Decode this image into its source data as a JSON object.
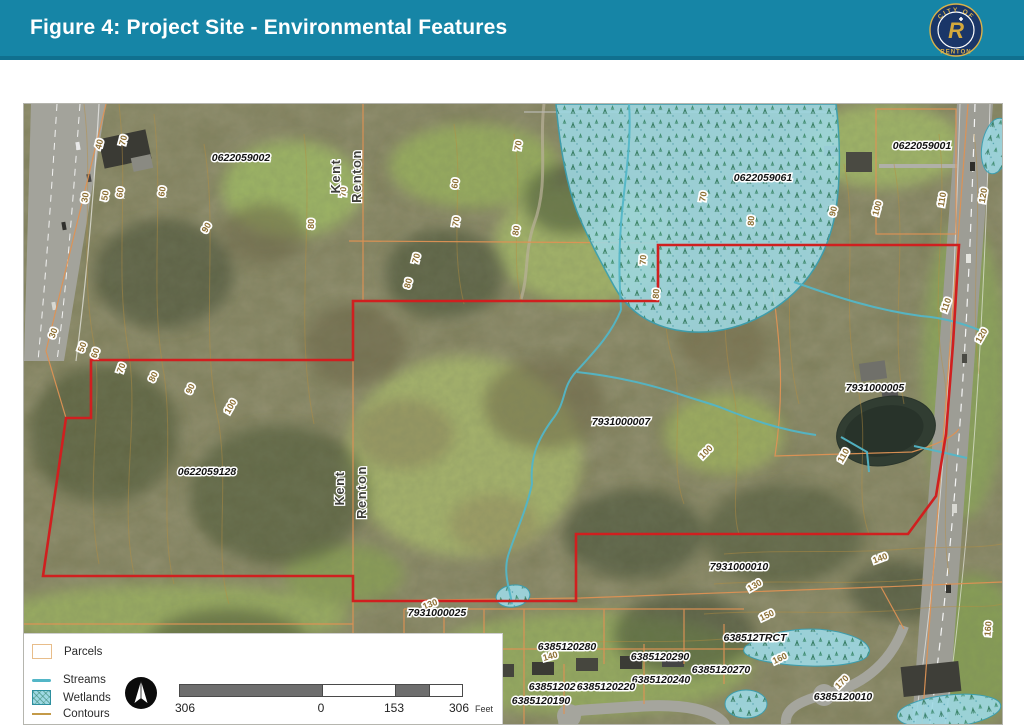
{
  "header": {
    "title": "Figure 4: Project Site - Environmental Features",
    "logo": {
      "top_text": "CITY OF",
      "bottom_text": "RENTON",
      "letter": "R"
    }
  },
  "legend": {
    "items": [
      {
        "label": "Parcels"
      },
      {
        "label": "Streams"
      },
      {
        "label": "Wetlands"
      },
      {
        "label": "Contours"
      }
    ],
    "scalebar": {
      "left": "306",
      "zero": "0",
      "mid": "153",
      "right": "306",
      "unit": "Feet"
    }
  },
  "map": {
    "colors": {
      "boundary_red": "#d01f1f",
      "stream_teal": "#53b6c7",
      "wetland_fill": "#9ed9e4",
      "parcel_line": "#de9254",
      "contour_line": "#b98f3f",
      "header_teal": "#1685a6"
    },
    "city_labels": [
      {
        "text": "Kent",
        "x": 316,
        "y": 72,
        "r": -90
      },
      {
        "text": "Renton",
        "x": 337,
        "y": 72,
        "r": -90
      },
      {
        "text": "Kent",
        "x": 320,
        "y": 384,
        "r": -90
      },
      {
        "text": "Renton",
        "x": 342,
        "y": 388,
        "r": -90
      }
    ],
    "parcel_labels": [
      {
        "text": "0622059002",
        "x": 217,
        "y": 57
      },
      {
        "text": "0622059001",
        "x": 898,
        "y": 45
      },
      {
        "text": "0622059061",
        "x": 739,
        "y": 77
      },
      {
        "text": "7931000005",
        "x": 851,
        "y": 287
      },
      {
        "text": "7931000007",
        "x": 597,
        "y": 321
      },
      {
        "text": "0622059128",
        "x": 183,
        "y": 371
      },
      {
        "text": "7931000010",
        "x": 715,
        "y": 466
      },
      {
        "text": "7931000025",
        "x": 413,
        "y": 512
      },
      {
        "text": "6385120280",
        "x": 543,
        "y": 546
      },
      {
        "text": "638512TRCT",
        "x": 731,
        "y": 537
      },
      {
        "text": "6385120290",
        "x": 636,
        "y": 556
      },
      {
        "text": "6385120270",
        "x": 697,
        "y": 569
      },
      {
        "text": "6385120240",
        "x": 637,
        "y": 579
      },
      {
        "text": "6385120200",
        "x": 534,
        "y": 586
      },
      {
        "text": "6385120220",
        "x": 582,
        "y": 586
      },
      {
        "text": "6385120190",
        "x": 517,
        "y": 600
      },
      {
        "text": "6385120010",
        "x": 819,
        "y": 596
      }
    ],
    "contour_labels": [
      {
        "v": "40",
        "x": 78,
        "y": 41,
        "r": -75
      },
      {
        "v": "70",
        "x": 102,
        "y": 37,
        "r": -75
      },
      {
        "v": "30",
        "x": 64,
        "y": 94,
        "r": -80
      },
      {
        "v": "50",
        "x": 84,
        "y": 92,
        "r": -80
      },
      {
        "v": "60",
        "x": 99,
        "y": 89,
        "r": -80
      },
      {
        "v": "60",
        "x": 141,
        "y": 88,
        "r": -80
      },
      {
        "v": "90",
        "x": 185,
        "y": 125,
        "r": -60
      },
      {
        "v": "80",
        "x": 290,
        "y": 120,
        "r": -88
      },
      {
        "v": "70",
        "x": 322,
        "y": 88,
        "r": -85
      },
      {
        "v": "70",
        "x": 497,
        "y": 42,
        "r": -80
      },
      {
        "v": "60",
        "x": 434,
        "y": 80,
        "r": -80
      },
      {
        "v": "70",
        "x": 435,
        "y": 118,
        "r": -80
      },
      {
        "v": "80",
        "x": 495,
        "y": 127,
        "r": -80
      },
      {
        "v": "70",
        "x": 395,
        "y": 155,
        "r": -75
      },
      {
        "v": "80",
        "x": 387,
        "y": 180,
        "r": -75
      },
      {
        "v": "30",
        "x": 32,
        "y": 230,
        "r": -70
      },
      {
        "v": "50",
        "x": 61,
        "y": 244,
        "r": -70
      },
      {
        "v": "60",
        "x": 74,
        "y": 250,
        "r": -70
      },
      {
        "v": "70",
        "x": 100,
        "y": 265,
        "r": -70
      },
      {
        "v": "80",
        "x": 132,
        "y": 274,
        "r": -65
      },
      {
        "v": "90",
        "x": 169,
        "y": 286,
        "r": -65
      },
      {
        "v": "100",
        "x": 209,
        "y": 304,
        "r": -60
      },
      {
        "v": "70",
        "x": 682,
        "y": 93,
        "r": -80
      },
      {
        "v": "80",
        "x": 730,
        "y": 117,
        "r": -85
      },
      {
        "v": "90",
        "x": 812,
        "y": 108,
        "r": -75
      },
      {
        "v": "100",
        "x": 856,
        "y": 105,
        "r": -75
      },
      {
        "v": "110",
        "x": 921,
        "y": 96,
        "r": -80
      },
      {
        "v": "120",
        "x": 962,
        "y": 92,
        "r": -80
      },
      {
        "v": "110",
        "x": 925,
        "y": 202,
        "r": -70
      },
      {
        "v": "120",
        "x": 960,
        "y": 233,
        "r": -60
      },
      {
        "v": "70",
        "x": 622,
        "y": 156,
        "r": -85
      },
      {
        "v": "80",
        "x": 635,
        "y": 190,
        "r": -85
      },
      {
        "v": "100",
        "x": 684,
        "y": 350,
        "r": -45
      },
      {
        "v": "110",
        "x": 822,
        "y": 353,
        "r": -60
      },
      {
        "v": "140",
        "x": 857,
        "y": 457,
        "r": -20
      },
      {
        "v": "130",
        "x": 732,
        "y": 484,
        "r": -30
      },
      {
        "v": "150",
        "x": 744,
        "y": 514,
        "r": -25
      },
      {
        "v": "140",
        "x": 527,
        "y": 555,
        "r": -15
      },
      {
        "v": "160",
        "x": 757,
        "y": 557,
        "r": -25
      },
      {
        "v": "170",
        "x": 820,
        "y": 580,
        "r": -45
      },
      {
        "v": "160",
        "x": 967,
        "y": 525,
        "r": -85
      },
      {
        "v": "130",
        "x": 407,
        "y": 503,
        "r": -20
      }
    ]
  }
}
